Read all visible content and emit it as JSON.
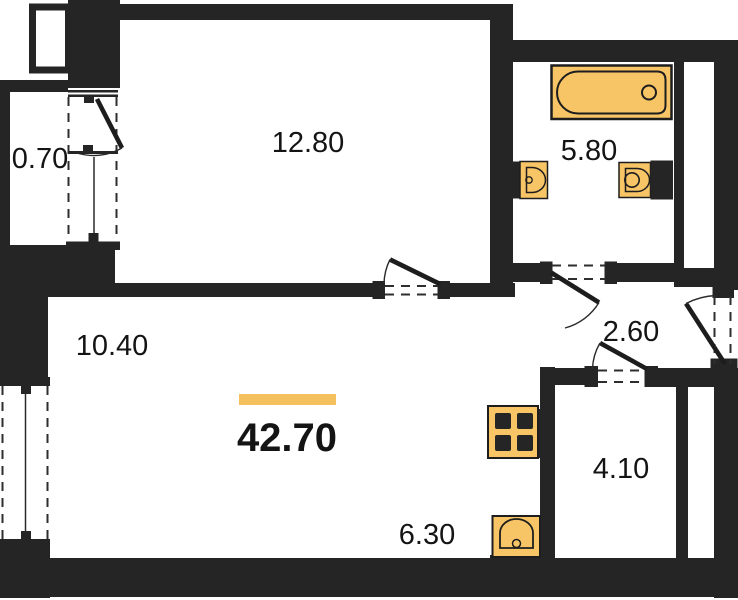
{
  "plan": {
    "type": "apartment-floor-plan",
    "total_area": "42.70",
    "rooms": {
      "balcony": "0.70",
      "bedroom": "12.80",
      "bathroom": "5.80",
      "living": "10.40",
      "hallway": "2.60",
      "kitchen": "6.30",
      "storage": "4.10"
    },
    "colors": {
      "wall": "#252525",
      "fixture_fill": "#F7C566",
      "fixture_stroke": "#1d1d1d",
      "accent_bar": "#F5C05E",
      "line": "#1d1d1d"
    },
    "icons": [
      "bathtub-icon",
      "bathroom-sink-icon",
      "toilet-icon",
      "stove-icon",
      "kitchen-sink-icon"
    ]
  }
}
